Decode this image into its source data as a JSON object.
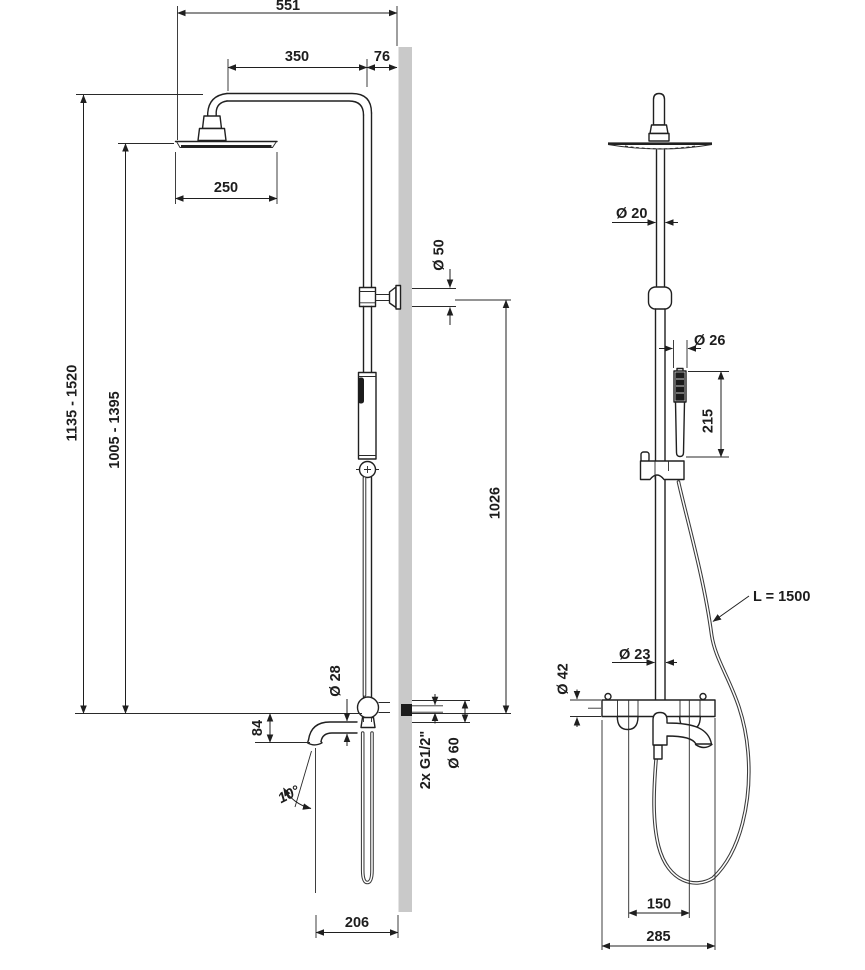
{
  "colors": {
    "wall": "#c9c9c9",
    "line": "#1f1f1f"
  },
  "dims": {
    "side": {
      "total_width": "551",
      "arm_projection": "350",
      "wall_clearance": "76",
      "head_diameter": "250",
      "overall_height": "1135 - 1520",
      "head_height": "1005 - 1395",
      "bracket_to_outlet": "1026",
      "bracket_rosette": "Ø 50",
      "spout_drop": "84",
      "spout_angle": "10°",
      "spout_diameter": "Ø 28",
      "inlet_thread": "2x G1/2\"",
      "inlet_rosette": "Ø 60",
      "spout_reach": "206"
    },
    "front": {
      "riser_diameter": "Ø 20",
      "handset_diameter": "Ø 26",
      "handset_length": "215",
      "hose_length": "L = 1500",
      "lower_riser_diameter": "Ø 23",
      "body_diameter": "Ø 42",
      "inlet_spacing": "150",
      "body_width": "285"
    }
  }
}
